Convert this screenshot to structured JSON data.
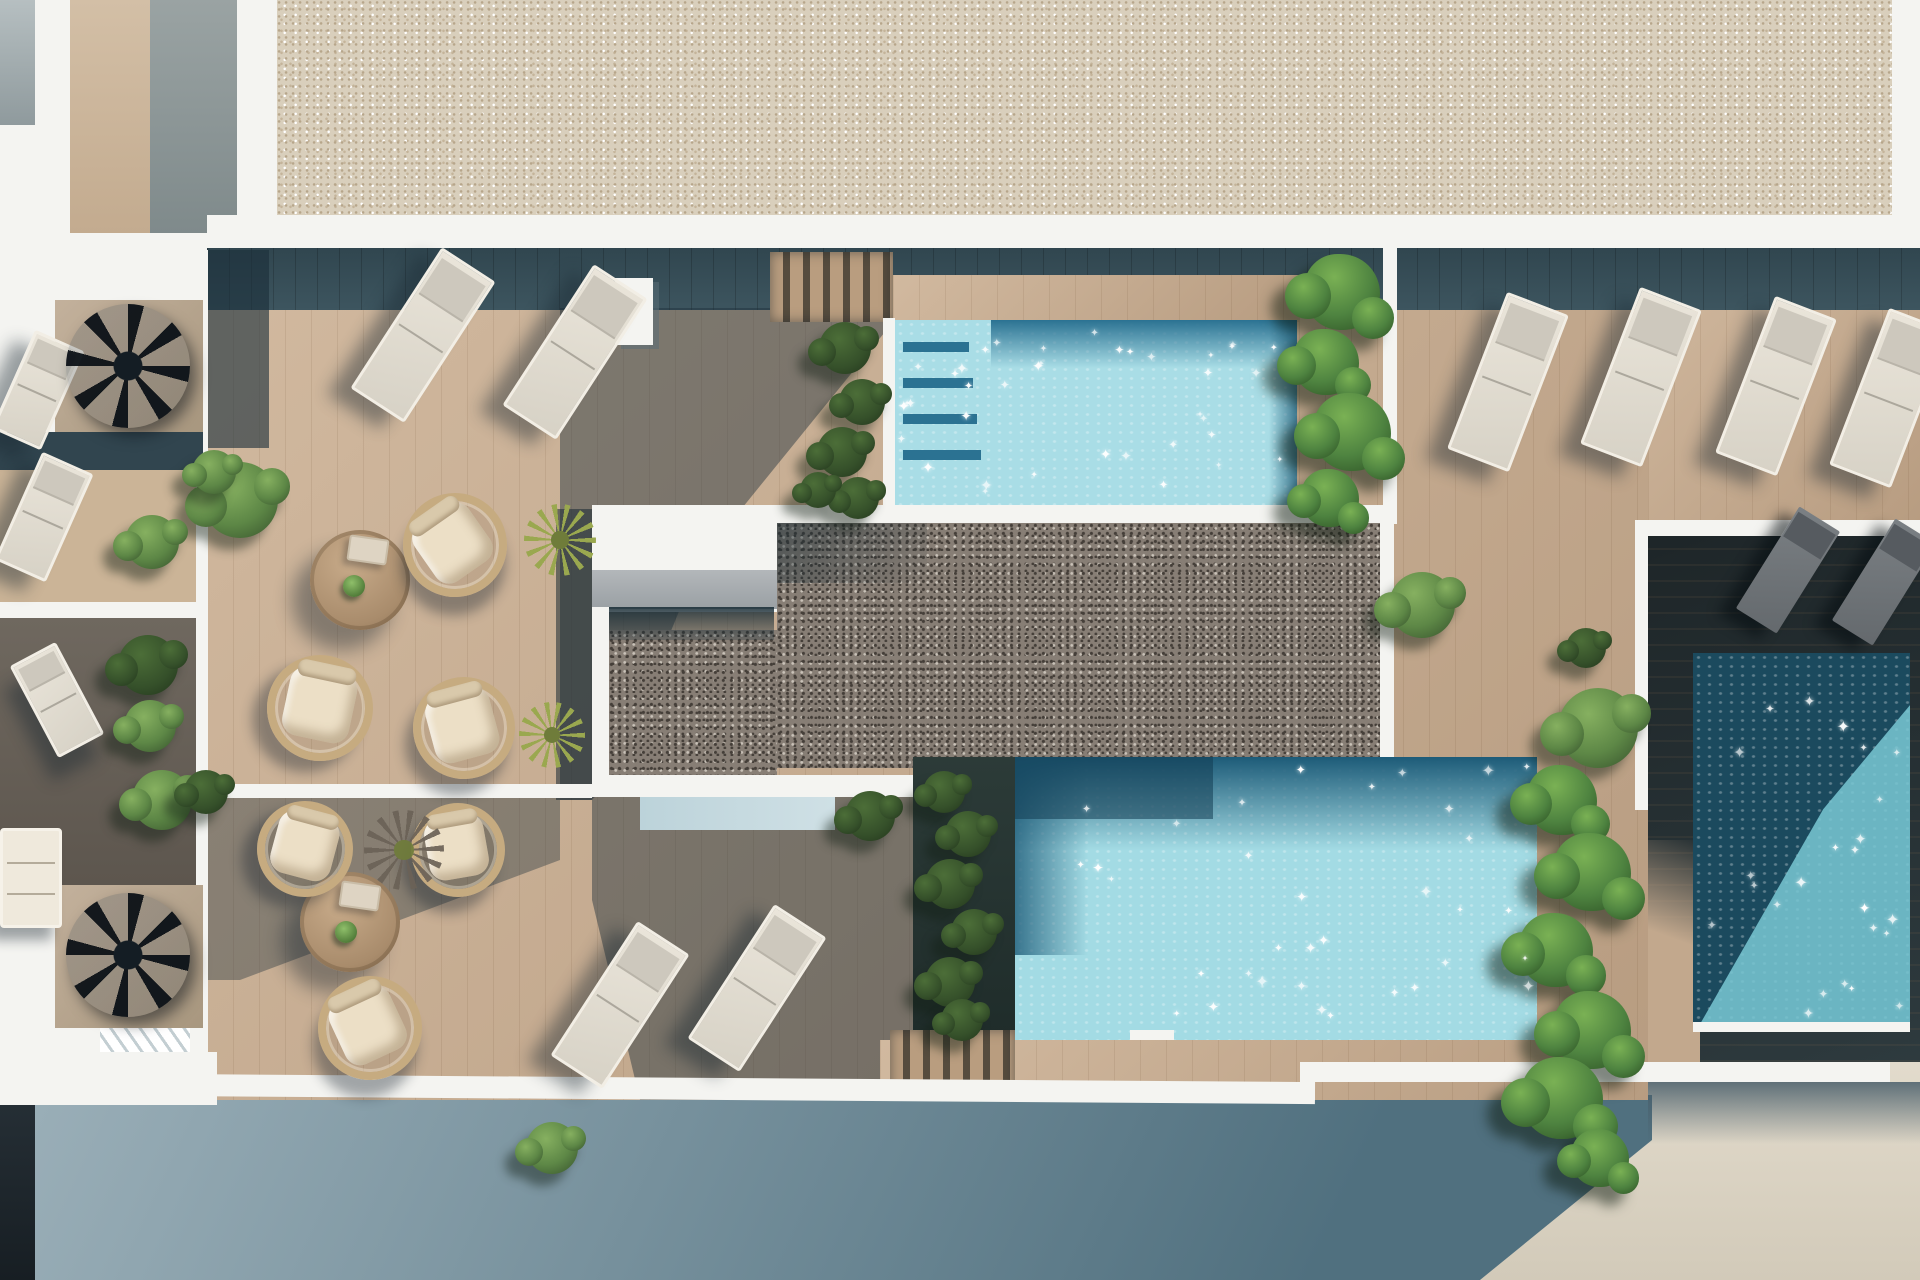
{
  "scene": {
    "kind": "architectural-3d-render",
    "view": "top-down aerial",
    "description": "Rooftop terrace render: wooden deck with two light pools, a dark private plunge pool, pebble roof zone, gravel roof, sun loungers, rattan chairs, round tables, planting and spiral staircases"
  },
  "colors": {
    "white": "#f4f4f1",
    "gravel": "#d9cfbc",
    "gravelDot": "#b7a68b",
    "gravelDot2": "#c4b49a",
    "deck": "#c2a88d",
    "shadowBand": "#3d555f",
    "pebble": "#877e75",
    "pebbleDark": "#453f39",
    "concrete": "#a9adb0",
    "poolTopLight": "#a9dde6",
    "poolTopDark": "#2b7292",
    "poolLowLight": "#a3dbe4",
    "poolLowDark": "#1d5b78",
    "poolRightDark": "#1b4a5e",
    "poolRightLight": "#79c8d3",
    "ground": "#ded7c8",
    "groundShadow1": "#93a9b2",
    "groundShadow2": "#4e6b7a",
    "darkSection": "#2e3a3e",
    "roomFloor": "#b5a490",
    "wallBeige": "#cdb79d",
    "wallGray": "#8e9897",
    "rattan": "#c6ab80",
    "cushion": "#ecdfc6",
    "loungerFrame": "#f2eee5",
    "bush": "#5d8746",
    "bushLight": "#86b060",
    "bushDark": "#3c5a30",
    "spike1": "#9aa84f",
    "spike2": "#6f7c3a",
    "darkBlock": "#20282e"
  },
  "counts": {
    "pools": 3,
    "white_sun_loungers": 8,
    "dark_sun_loungers": 2,
    "left_wing_loungers": 3,
    "basket_chairs": 6,
    "round_tables": 2,
    "spiral_staircases": 2,
    "sofas": 1
  },
  "furniture": {
    "white_loungers": [
      {
        "id": "deck-topleft-1",
        "cx": 423,
        "cy": 335,
        "w": 64,
        "len": 168,
        "rot": 33
      },
      {
        "id": "deck-topleft-2",
        "cx": 575,
        "cy": 352,
        "w": 64,
        "len": 168,
        "rot": 33
      },
      {
        "id": "deck-bottom-1",
        "cx": 620,
        "cy": 1005,
        "w": 62,
        "len": 160,
        "rot": 33
      },
      {
        "id": "deck-bottom-2",
        "cx": 757,
        "cy": 988,
        "w": 62,
        "len": 160,
        "rot": 33
      },
      {
        "id": "deck-topright-1",
        "cx": 1508,
        "cy": 382,
        "w": 66,
        "len": 168,
        "rot": 21
      },
      {
        "id": "deck-topright-2",
        "cx": 1641,
        "cy": 377,
        "w": 66,
        "len": 168,
        "rot": 21
      },
      {
        "id": "deck-topright-3",
        "cx": 1776,
        "cy": 386,
        "w": 66,
        "len": 168,
        "rot": 21
      },
      {
        "id": "deck-topright-4",
        "cx": 1890,
        "cy": 398,
        "w": 66,
        "len": 168,
        "rot": 21
      }
    ],
    "left_wing_loungers": [
      {
        "id": "balcony-lounger-1",
        "cx": 38,
        "cy": 390,
        "w": 54,
        "len": 108,
        "rot": 24
      },
      {
        "id": "balcony-lounger-2",
        "cx": 44,
        "cy": 517,
        "w": 56,
        "len": 118,
        "rot": 24
      },
      {
        "id": "balcony-lounger-3",
        "cx": 57,
        "cy": 700,
        "w": 52,
        "len": 104,
        "rot": -28
      }
    ],
    "dark_loungers": [
      {
        "id": "private-lounger-1",
        "cx": 1788,
        "cy": 570,
        "w": 48,
        "len": 120,
        "rot": 32
      },
      {
        "id": "private-lounger-2",
        "cx": 1884,
        "cy": 582,
        "w": 48,
        "len": 120,
        "rot": 32
      }
    ],
    "basket_chairs": [
      {
        "id": "chair-1",
        "cx": 455,
        "cy": 545,
        "d": 104,
        "rot": -35
      },
      {
        "id": "chair-2",
        "cx": 320,
        "cy": 708,
        "d": 106,
        "rot": 12
      },
      {
        "id": "chair-3",
        "cx": 464,
        "cy": 728,
        "d": 102,
        "rot": -15
      },
      {
        "id": "chair-4",
        "cx": 305,
        "cy": 849,
        "d": 96,
        "rot": 15
      },
      {
        "id": "chair-5",
        "cx": 458,
        "cy": 850,
        "d": 94,
        "rot": -10
      },
      {
        "id": "chair-6",
        "cx": 370,
        "cy": 1028,
        "d": 104,
        "rot": -25
      }
    ],
    "round_tables": [
      {
        "id": "table-1",
        "cx": 360,
        "cy": 580,
        "r": 50
      },
      {
        "id": "table-2",
        "cx": 350,
        "cy": 922,
        "r": 50
      }
    ],
    "sofa": {
      "x": 0,
      "y": 828,
      "w": 62,
      "h": 100
    },
    "spiral_staircases": [
      {
        "id": "spiral-1",
        "cx": 128,
        "cy": 366,
        "r": 62
      },
      {
        "id": "spiral-2",
        "cx": 128,
        "cy": 955,
        "r": 62
      }
    ],
    "bushes": [
      {
        "cx": 240,
        "cy": 500,
        "r": 38,
        "tone": "normal"
      },
      {
        "cx": 152,
        "cy": 542,
        "r": 27,
        "tone": "normal"
      },
      {
        "cx": 214,
        "cy": 472,
        "r": 22,
        "tone": "normal"
      },
      {
        "cx": 148,
        "cy": 665,
        "r": 30,
        "tone": "dark"
      },
      {
        "cx": 150,
        "cy": 726,
        "r": 26,
        "tone": "normal"
      },
      {
        "cx": 162,
        "cy": 800,
        "r": 30,
        "tone": "normal"
      },
      {
        "cx": 206,
        "cy": 792,
        "r": 22,
        "tone": "dark"
      },
      {
        "cx": 845,
        "cy": 348,
        "r": 26,
        "tone": "dark"
      },
      {
        "cx": 862,
        "cy": 402,
        "r": 23,
        "tone": "dark"
      },
      {
        "cx": 842,
        "cy": 452,
        "r": 25,
        "tone": "dark"
      },
      {
        "cx": 858,
        "cy": 498,
        "r": 21,
        "tone": "dark"
      },
      {
        "cx": 818,
        "cy": 490,
        "r": 18,
        "tone": "dark"
      },
      {
        "cx": 1422,
        "cy": 605,
        "r": 33,
        "tone": "normal"
      },
      {
        "cx": 1598,
        "cy": 728,
        "r": 40,
        "tone": "normal"
      },
      {
        "cx": 1586,
        "cy": 648,
        "r": 20,
        "tone": "dark"
      },
      {
        "cx": 870,
        "cy": 816,
        "r": 25,
        "tone": "dark"
      },
      {
        "cx": 944,
        "cy": 792,
        "r": 21,
        "tone": "dark"
      },
      {
        "cx": 968,
        "cy": 834,
        "r": 23,
        "tone": "dark"
      },
      {
        "cx": 950,
        "cy": 884,
        "r": 25,
        "tone": "dark"
      },
      {
        "cx": 974,
        "cy": 932,
        "r": 23,
        "tone": "dark"
      },
      {
        "cx": 950,
        "cy": 982,
        "r": 25,
        "tone": "dark"
      },
      {
        "cx": 962,
        "cy": 1020,
        "r": 21,
        "tone": "dark"
      },
      {
        "cx": 552,
        "cy": 1148,
        "r": 26,
        "tone": "normal"
      }
    ],
    "ivy_clusters": [
      {
        "cx": 1342,
        "cy": 292,
        "r": 38
      },
      {
        "cx": 1326,
        "cy": 362,
        "r": 33
      },
      {
        "cx": 1352,
        "cy": 432,
        "r": 39
      },
      {
        "cx": 1330,
        "cy": 498,
        "r": 29
      },
      {
        "cx": 1562,
        "cy": 800,
        "r": 35
      },
      {
        "cx": 1592,
        "cy": 872,
        "r": 39
      },
      {
        "cx": 1556,
        "cy": 950,
        "r": 37
      },
      {
        "cx": 1592,
        "cy": 1030,
        "r": 39
      },
      {
        "cx": 1562,
        "cy": 1098,
        "r": 41
      },
      {
        "cx": 1600,
        "cy": 1158,
        "r": 29
      }
    ],
    "spiky_plants": [
      {
        "id": "yucca-1",
        "cx": 560,
        "cy": 540,
        "r": 36,
        "kind": "light"
      },
      {
        "id": "yucca-2",
        "cx": 552,
        "cy": 735,
        "r": 33,
        "kind": "light"
      },
      {
        "id": "agave-shadow",
        "cx": 404,
        "cy": 850,
        "r": 40,
        "kind": "dark"
      }
    ],
    "table_props": [
      {
        "table": 0,
        "tray": {
          "dx": 8,
          "dy": -30
        },
        "plant": {
          "dx": -6,
          "dy": 6
        }
      },
      {
        "table": 1,
        "tray": {
          "dx": 10,
          "dy": -26
        },
        "plant": {
          "dx": -4,
          "dy": 10
        }
      }
    ]
  },
  "pools": [
    {
      "id": "top-pool",
      "x": 893,
      "y": 320,
      "w": 404,
      "h": 186,
      "sparkles": 38,
      "seed": 7
    },
    {
      "id": "lower-pool",
      "x": 1015,
      "y": 757,
      "w": 522,
      "h": 283,
      "sparkles": 34,
      "seed": 19
    },
    {
      "id": "private-pool",
      "x": 1693,
      "y": 653,
      "w": 217,
      "h": 372,
      "sparkles": 24,
      "seed": 41
    }
  ]
}
